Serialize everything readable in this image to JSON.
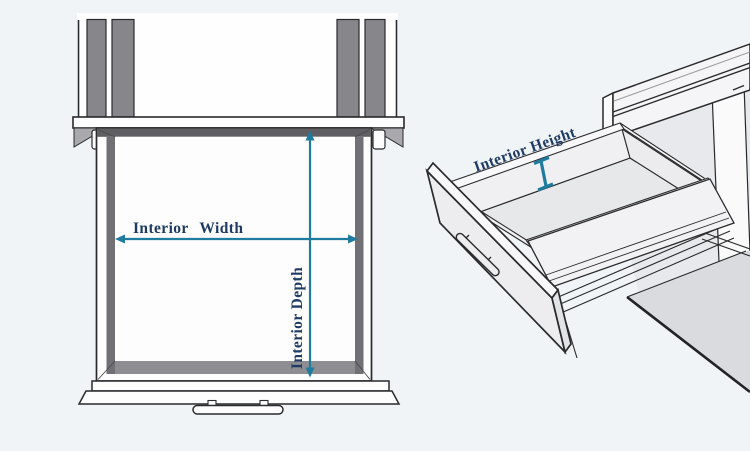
{
  "diagram": {
    "title_context": "drawer interior dimensions diagram",
    "colors": {
      "background": "#f1f4f7",
      "line": "#2a2a2c",
      "dimension": "#1f7c9e",
      "label": "#1f3b63",
      "panel_gray": "#87878b",
      "wall_gray": "#717175",
      "surface_light": "#e8e9ec"
    },
    "left_view": {
      "width_label": "Interior Width",
      "depth_label": "Interior Depth"
    },
    "right_view": {
      "height_label": "Interior Height"
    }
  }
}
